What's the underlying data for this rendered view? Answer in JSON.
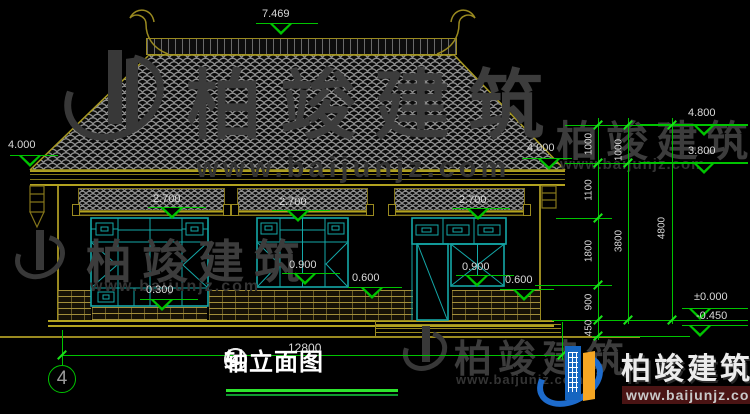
{
  "drawing": {
    "title": {
      "axis_left": "4",
      "dash": "-",
      "axis_right": "1",
      "text": "轴立面图"
    },
    "axis_bubble": "4",
    "bottom_dim": "12800",
    "watermark": {
      "name": "柏竣建筑",
      "url": "www.baijunjz.com"
    },
    "logo": {
      "name": "柏竣建筑",
      "url": "www.baijunjz.com"
    },
    "colors": {
      "dim_green": "#00c400",
      "line_olive": "#9a8a20",
      "frame_cyan": "#14a8a8",
      "text_light": "#d9d9d9",
      "logo_blue": "#1565c0",
      "logo_orange": "#f5a623"
    },
    "markers": [
      {
        "label": "7.469",
        "tx": 262,
        "ty": 8,
        "x1": 256,
        "x2": 318,
        "ly": 23,
        "cx": 281
      },
      {
        "label": "4.000",
        "tx": 8,
        "ty": 139,
        "x1": 10,
        "x2": 58,
        "ly": 155,
        "cx": 30
      },
      {
        "label": "4.000",
        "tx": 527,
        "ty": 142,
        "x1": 522,
        "x2": 572,
        "ly": 158,
        "cx": 549
      },
      {
        "label": "4.800",
        "tx": 688,
        "ty": 107,
        "x1": 640,
        "x2": 748,
        "ly": 124,
        "cx": 704
      },
      {
        "label": "3.800",
        "tx": 688,
        "ty": 145,
        "x1": 640,
        "x2": 748,
        "ly": 162,
        "cx": 704
      },
      {
        "label": "2.700",
        "tx": 153,
        "ty": 193,
        "x1": 148,
        "x2": 206,
        "ly": 207,
        "cx": 172
      },
      {
        "label": "2.700",
        "tx": 279,
        "ty": 196,
        "x1": 272,
        "x2": 330,
        "ly": 210,
        "cx": 298
      },
      {
        "label": "2.700",
        "tx": 459,
        "ty": 194,
        "x1": 452,
        "x2": 510,
        "ly": 208,
        "cx": 478
      },
      {
        "label": "0.900",
        "tx": 289,
        "ty": 259,
        "x1": 282,
        "x2": 340,
        "ly": 273,
        "cx": 305
      },
      {
        "label": "0.900",
        "tx": 462,
        "ty": 261,
        "x1": 456,
        "x2": 514,
        "ly": 275,
        "cx": 477
      },
      {
        "label": "0.600",
        "tx": 352,
        "ty": 272,
        "x1": 348,
        "x2": 402,
        "ly": 287,
        "cx": 372
      },
      {
        "label": "0.600",
        "tx": 505,
        "ty": 274,
        "x1": 500,
        "x2": 554,
        "ly": 289,
        "cx": 524
      },
      {
        "label": "0.300",
        "tx": 146,
        "ty": 284,
        "x1": 140,
        "x2": 198,
        "ly": 299,
        "cx": 162
      },
      {
        "label": "±0.000",
        "tx": 694,
        "ty": 291,
        "x1": 682,
        "x2": 748,
        "ly": 308,
        "cx": 700
      },
      {
        "label": "-0.450",
        "tx": 696,
        "ty": 310,
        "x1": 682,
        "x2": 748,
        "ly": 325,
        "cx": 700
      }
    ],
    "vdims": [
      {
        "t": "1000",
        "x": 589,
        "y": 144
      },
      {
        "t": "1100",
        "x": 589,
        "y": 190
      },
      {
        "t": "1800",
        "x": 589,
        "y": 251
      },
      {
        "t": "900",
        "x": 589,
        "y": 302
      },
      {
        "t": "450",
        "x": 589,
        "y": 328
      },
      {
        "t": "1000",
        "x": 619,
        "y": 150
      },
      {
        "t": "3800",
        "x": 619,
        "y": 241
      },
      {
        "t": "4800",
        "x": 662,
        "y": 228
      }
    ],
    "chains": [
      {
        "x": 598,
        "y1": 118,
        "y2": 340
      },
      {
        "x": 628,
        "y1": 118,
        "y2": 324
      },
      {
        "x": 672,
        "y1": 118,
        "y2": 324
      },
      {
        "x": 62,
        "y1": 330,
        "y2": 365
      },
      {
        "x": 562,
        "y1": 322,
        "y2": 360
      }
    ],
    "extlines": [
      {
        "x1": 565,
        "x2": 748,
        "y": 125
      },
      {
        "x1": 565,
        "x2": 748,
        "y": 163
      },
      {
        "x1": 556,
        "x2": 612,
        "y": 218
      },
      {
        "x1": 535,
        "x2": 612,
        "y": 285
      },
      {
        "x1": 552,
        "x2": 748,
        "y": 320
      },
      {
        "x1": 592,
        "x2": 690,
        "y": 336
      },
      {
        "x1": 62,
        "x2": 562,
        "y": 355
      }
    ],
    "ticks": [
      {
        "x": 598,
        "y": 125
      },
      {
        "x": 598,
        "y": 163
      },
      {
        "x": 598,
        "y": 218
      },
      {
        "x": 598,
        "y": 285
      },
      {
        "x": 598,
        "y": 320
      },
      {
        "x": 598,
        "y": 336
      },
      {
        "x": 628,
        "y": 125
      },
      {
        "x": 628,
        "y": 163
      },
      {
        "x": 628,
        "y": 320
      },
      {
        "x": 672,
        "y": 125
      },
      {
        "x": 672,
        "y": 320
      },
      {
        "x": 62,
        "y": 355
      },
      {
        "x": 562,
        "y": 355
      }
    ]
  }
}
